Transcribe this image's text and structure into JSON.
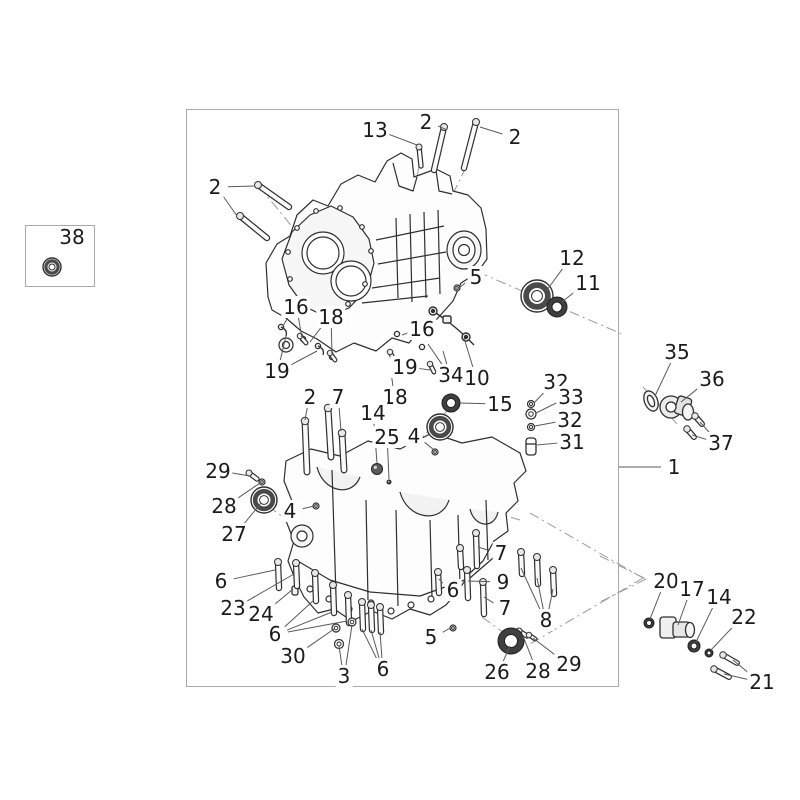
{
  "page": {
    "background": "#ffffff"
  },
  "inset_panel": {
    "part_label": "38",
    "box": [
      25,
      225,
      68,
      60
    ]
  },
  "diagram": {
    "box": [
      186,
      109,
      431,
      576
    ],
    "border_color": "#a9a9a9",
    "art_color": "#2f2f2f",
    "leader_color": "#5a5a5a",
    "phantom_color": "#9b9b9b",
    "drawing_subject": "engine-crankcase-exploded-view",
    "callouts": [
      {
        "text": "13",
        "x": 375,
        "y": 130,
        "targets": [
          [
            417,
            145
          ]
        ]
      },
      {
        "text": "2",
        "x": 426,
        "y": 122,
        "targets": [
          [
            447,
            130
          ]
        ]
      },
      {
        "text": "2",
        "x": 515,
        "y": 137,
        "targets": [
          [
            480,
            127
          ]
        ]
      },
      {
        "text": "2",
        "x": 215,
        "y": 187,
        "targets": [
          [
            254,
            186
          ],
          [
            237,
            216
          ]
        ]
      },
      {
        "text": "12",
        "x": 572,
        "y": 258,
        "targets": [
          [
            547,
            290
          ]
        ]
      },
      {
        "text": "11",
        "x": 588,
        "y": 283,
        "targets": [
          [
            562,
            302
          ]
        ]
      },
      {
        "text": "5",
        "x": 476,
        "y": 277,
        "targets": [
          [
            459,
            288
          ]
        ]
      },
      {
        "text": "16",
        "x": 296,
        "y": 307,
        "targets": [
          [
            283,
            326
          ],
          [
            302,
            338
          ]
        ]
      },
      {
        "text": "18",
        "x": 331,
        "y": 317,
        "targets": [
          [
            310,
            342
          ],
          [
            332,
            355
          ]
        ]
      },
      {
        "text": "19",
        "x": 277,
        "y": 371,
        "targets": [
          [
            286,
            336
          ],
          [
            317,
            351
          ]
        ]
      },
      {
        "text": "16",
        "x": 422,
        "y": 329,
        "targets": [
          [
            402,
            335
          ]
        ]
      },
      {
        "text": "19",
        "x": 405,
        "y": 367,
        "targets": [
          [
            393,
            359
          ],
          [
            430,
            370
          ]
        ]
      },
      {
        "text": "34",
        "x": 451,
        "y": 375,
        "targets": [
          [
            428,
            344
          ],
          [
            443,
            351
          ]
        ]
      },
      {
        "text": "10",
        "x": 477,
        "y": 378,
        "targets": [
          [
            464,
            338
          ]
        ]
      },
      {
        "text": "18",
        "x": 395,
        "y": 397,
        "targets": [
          [
            391,
            372
          ]
        ]
      },
      {
        "text": "15",
        "x": 500,
        "y": 404,
        "targets": [
          [
            460,
            403
          ]
        ]
      },
      {
        "text": "32",
        "x": 556,
        "y": 382,
        "targets": [
          [
            534,
            403
          ]
        ]
      },
      {
        "text": "33",
        "x": 571,
        "y": 397,
        "targets": [
          [
            536,
            413
          ]
        ]
      },
      {
        "text": "32",
        "x": 570,
        "y": 420,
        "targets": [
          [
            535,
            426
          ]
        ]
      },
      {
        "text": "31",
        "x": 572,
        "y": 442,
        "targets": [
          [
            537,
            445
          ]
        ]
      },
      {
        "text": "35",
        "x": 677,
        "y": 352,
        "targets": [
          [
            655,
            396
          ]
        ]
      },
      {
        "text": "36",
        "x": 712,
        "y": 379,
        "targets": [
          [
            681,
            402
          ]
        ]
      },
      {
        "text": "37",
        "x": 721,
        "y": 443,
        "targets": [
          [
            700,
            422
          ],
          [
            692,
            435
          ]
        ]
      },
      {
        "text": "1",
        "x": 674,
        "y": 467,
        "targets": [
          [
            618,
            467
          ]
        ]
      },
      {
        "text": "14",
        "x": 373,
        "y": 413,
        "targets": [
          [
            377,
            463
          ]
        ]
      },
      {
        "text": "25",
        "x": 387,
        "y": 437,
        "targets": [
          [
            389,
            479
          ]
        ]
      },
      {
        "text": "4",
        "x": 414,
        "y": 436,
        "targets": [
          [
            434,
            450
          ]
        ]
      },
      {
        "text": "2",
        "x": 310,
        "y": 397,
        "targets": [
          [
            305,
            420
          ]
        ]
      },
      {
        "text": "7",
        "x": 338,
        "y": 397,
        "targets": [
          [
            341,
            431
          ]
        ]
      },
      {
        "text": "29",
        "x": 218,
        "y": 471,
        "targets": [
          [
            250,
            476
          ]
        ]
      },
      {
        "text": "28",
        "x": 224,
        "y": 506,
        "targets": [
          [
            260,
            483
          ]
        ]
      },
      {
        "text": "27",
        "x": 234,
        "y": 534,
        "targets": [
          [
            261,
            503
          ]
        ]
      },
      {
        "text": "4",
        "x": 290,
        "y": 511,
        "targets": [
          [
            314,
            506
          ]
        ]
      },
      {
        "text": "6",
        "x": 221,
        "y": 581,
        "targets": [
          [
            275,
            570
          ]
        ]
      },
      {
        "text": "23",
        "x": 233,
        "y": 608,
        "targets": [
          [
            294,
            574
          ]
        ]
      },
      {
        "text": "24",
        "x": 261,
        "y": 614,
        "targets": [
          [
            293,
            589
          ]
        ]
      },
      {
        "text": "6",
        "x": 275,
        "y": 634,
        "targets": [
          [
            314,
            600
          ],
          [
            332,
            612
          ],
          [
            347,
            621
          ]
        ]
      },
      {
        "text": "30",
        "x": 293,
        "y": 656,
        "targets": [
          [
            334,
            629
          ]
        ]
      },
      {
        "text": "3",
        "x": 344,
        "y": 676,
        "targets": [
          [
            339,
            646
          ],
          [
            352,
            625
          ]
        ]
      },
      {
        "text": "6",
        "x": 383,
        "y": 669,
        "targets": [
          [
            362,
            629
          ],
          [
            371,
            630
          ],
          [
            380,
            632
          ]
        ]
      },
      {
        "text": "5",
        "x": 431,
        "y": 637,
        "targets": [
          [
            452,
            627
          ]
        ]
      },
      {
        "text": "7",
        "x": 501,
        "y": 553,
        "targets": [
          [
            478,
            547
          ]
        ]
      },
      {
        "text": "9",
        "x": 503,
        "y": 582,
        "targets": [
          [
            468,
            581
          ]
        ]
      },
      {
        "text": "6",
        "x": 453,
        "y": 590,
        "targets": [
          [
            439,
            579
          ]
        ]
      },
      {
        "text": "7",
        "x": 505,
        "y": 608,
        "targets": [
          [
            484,
            597
          ]
        ]
      },
      {
        "text": "8",
        "x": 546,
        "y": 620,
        "targets": [
          [
            521,
            568
          ],
          [
            537,
            578
          ],
          [
            553,
            589
          ]
        ]
      },
      {
        "text": "26",
        "x": 497,
        "y": 672,
        "targets": [
          [
            510,
            646
          ]
        ]
      },
      {
        "text": "28",
        "x": 538,
        "y": 671,
        "targets": [
          [
            523,
            636
          ]
        ]
      },
      {
        "text": "29",
        "x": 569,
        "y": 664,
        "targets": [
          [
            533,
            638
          ]
        ]
      },
      {
        "text": "20",
        "x": 666,
        "y": 581,
        "targets": [
          [
            650,
            619
          ]
        ]
      },
      {
        "text": "17",
        "x": 692,
        "y": 589,
        "targets": [
          [
            678,
            625
          ]
        ]
      },
      {
        "text": "14",
        "x": 719,
        "y": 597,
        "targets": [
          [
            696,
            642
          ]
        ]
      },
      {
        "text": "22",
        "x": 744,
        "y": 617,
        "targets": [
          [
            711,
            650
          ]
        ]
      },
      {
        "text": "21",
        "x": 762,
        "y": 682,
        "targets": [
          [
            733,
            660
          ],
          [
            724,
            674
          ]
        ]
      },
      {
        "text": "38",
        "x": 72,
        "y": 237,
        "targets": []
      }
    ],
    "fasteners": [
      {
        "name": "stud-bolt",
        "x1": 419,
        "y1": 147,
        "x2": 421,
        "y2": 166,
        "w": 3
      },
      {
        "name": "stud-bolt",
        "x1": 444,
        "y1": 127,
        "x2": 434,
        "y2": 170,
        "w": 4
      },
      {
        "name": "stud-bolt",
        "x1": 476,
        "y1": 122,
        "x2": 464,
        "y2": 168,
        "w": 4
      },
      {
        "name": "stud-bolt",
        "x1": 258,
        "y1": 185,
        "x2": 289,
        "y2": 207,
        "w": 4
      },
      {
        "name": "stud-bolt",
        "x1": 240,
        "y1": 216,
        "x2": 267,
        "y2": 238,
        "w": 4
      },
      {
        "name": "stud-bolt",
        "x1": 305,
        "y1": 421,
        "x2": 307,
        "y2": 472,
        "w": 4.5
      },
      {
        "name": "stud-bolt",
        "x1": 328,
        "y1": 408,
        "x2": 331,
        "y2": 457,
        "w": 4.5
      },
      {
        "name": "stud-bolt",
        "x1": 342,
        "y1": 433,
        "x2": 344,
        "y2": 470,
        "w": 4.5
      },
      {
        "name": "hex-bolt",
        "x1": 278,
        "y1": 562,
        "x2": 279,
        "y2": 588,
        "w": 4
      },
      {
        "name": "hex-bolt",
        "x1": 296,
        "y1": 563,
        "x2": 297,
        "y2": 586,
        "w": 4
      },
      {
        "name": "hex-bolt",
        "x1": 315,
        "y1": 573,
        "x2": 316,
        "y2": 601,
        "w": 4
      },
      {
        "name": "hex-bolt",
        "x1": 333,
        "y1": 585,
        "x2": 334,
        "y2": 613,
        "w": 4
      },
      {
        "name": "hex-bolt",
        "x1": 348,
        "y1": 595,
        "x2": 349,
        "y2": 623,
        "w": 4
      },
      {
        "name": "hex-bolt",
        "x1": 362,
        "y1": 602,
        "x2": 363,
        "y2": 629,
        "w": 4
      },
      {
        "name": "hex-bolt",
        "x1": 371,
        "y1": 605,
        "x2": 372,
        "y2": 630,
        "w": 4
      },
      {
        "name": "hex-bolt",
        "x1": 380,
        "y1": 607,
        "x2": 381,
        "y2": 632,
        "w": 4
      },
      {
        "name": "hex-bolt",
        "x1": 438,
        "y1": 572,
        "x2": 439,
        "y2": 593,
        "w": 4
      },
      {
        "name": "hex-bolt",
        "x1": 467,
        "y1": 570,
        "x2": 468,
        "y2": 598,
        "w": 4
      },
      {
        "name": "hex-bolt",
        "x1": 483,
        "y1": 582,
        "x2": 484,
        "y2": 614,
        "w": 4
      },
      {
        "name": "hex-bolt",
        "x1": 476,
        "y1": 533,
        "x2": 477,
        "y2": 566,
        "w": 4
      },
      {
        "name": "hex-bolt",
        "x1": 460,
        "y1": 548,
        "x2": 461,
        "y2": 567,
        "w": 4
      },
      {
        "name": "hex-bolt",
        "x1": 521,
        "y1": 552,
        "x2": 522,
        "y2": 574,
        "w": 4
      },
      {
        "name": "hex-bolt",
        "x1": 537,
        "y1": 557,
        "x2": 538,
        "y2": 584,
        "w": 4
      },
      {
        "name": "hex-bolt",
        "x1": 553,
        "y1": 570,
        "x2": 554,
        "y2": 594,
        "w": 4
      },
      {
        "name": "screw",
        "x1": 695,
        "y1": 416,
        "x2": 702,
        "y2": 424,
        "w": 3.5
      },
      {
        "name": "screw",
        "x1": 687,
        "y1": 429,
        "x2": 694,
        "y2": 437,
        "w": 3.5
      },
      {
        "name": "screw",
        "x1": 723,
        "y1": 655,
        "x2": 737,
        "y2": 663,
        "w": 3.5
      },
      {
        "name": "screw",
        "x1": 714,
        "y1": 669,
        "x2": 729,
        "y2": 677,
        "w": 3.5
      },
      {
        "name": "screw",
        "x1": 249,
        "y1": 473,
        "x2": 257,
        "y2": 479,
        "w": 3
      },
      {
        "name": "screw",
        "x1": 519,
        "y1": 631,
        "x2": 527,
        "y2": 636,
        "w": 3
      },
      {
        "name": "screw",
        "x1": 529,
        "y1": 635,
        "x2": 535,
        "y2": 639,
        "w": 2.5
      },
      {
        "name": "screw",
        "x1": 300,
        "y1": 336,
        "x2": 306,
        "y2": 343,
        "w": 2.5
      },
      {
        "name": "screw",
        "x1": 330,
        "y1": 353,
        "x2": 335,
        "y2": 360,
        "w": 2.5
      },
      {
        "name": "screw",
        "x1": 390,
        "y1": 352,
        "x2": 394,
        "y2": 360,
        "w": 2.5
      },
      {
        "name": "screw",
        "x1": 430,
        "y1": 364,
        "x2": 434,
        "y2": 372,
        "w": 2.5
      }
    ],
    "rings": [
      {
        "name": "ball-bearing",
        "cx": 537,
        "cy": 296,
        "r": 16,
        "style": "bearing"
      },
      {
        "name": "oil-seal",
        "cx": 557,
        "cy": 307,
        "r": 10,
        "style": "seal"
      },
      {
        "name": "roller-bearing",
        "cx": 451,
        "cy": 403,
        "r": 9,
        "style": "seal"
      },
      {
        "name": "ball-bearing",
        "cx": 440,
        "cy": 427,
        "r": 13,
        "style": "bearing"
      },
      {
        "name": "ball-bearing",
        "cx": 264,
        "cy": 500,
        "r": 13,
        "style": "bearing"
      },
      {
        "name": "oil-seal",
        "cx": 511,
        "cy": 641,
        "r": 13,
        "style": "seal"
      },
      {
        "name": "o-ring",
        "cx": 649,
        "cy": 623,
        "r": 5,
        "style": "seal"
      },
      {
        "name": "washer",
        "cx": 694,
        "cy": 646,
        "r": 6,
        "style": "seal"
      },
      {
        "name": "o-ring",
        "cx": 709,
        "cy": 653,
        "r": 4,
        "style": "seal"
      },
      {
        "name": "washer",
        "cx": 531,
        "cy": 404,
        "r": 3.5,
        "style": "washer"
      },
      {
        "name": "nut",
        "cx": 531,
        "cy": 414,
        "r": 5,
        "style": "washer"
      },
      {
        "name": "washer",
        "cx": 531,
        "cy": 427,
        "r": 3.5,
        "style": "washer"
      },
      {
        "name": "ball-plug",
        "cx": 377,
        "cy": 469,
        "r": 5.5,
        "style": "ball"
      },
      {
        "name": "ball-plug",
        "cx": 389,
        "cy": 482,
        "r": 2,
        "style": "ball"
      },
      {
        "name": "dowel",
        "cx": 435,
        "cy": 452,
        "r": 3,
        "style": "washer"
      },
      {
        "name": "dowel",
        "cx": 316,
        "cy": 506,
        "r": 3,
        "style": "washer"
      },
      {
        "name": "dowel",
        "cx": 457,
        "cy": 288,
        "r": 3,
        "style": "washer"
      },
      {
        "name": "dowel",
        "cx": 453,
        "cy": 628,
        "r": 3,
        "style": "washer"
      },
      {
        "name": "washer",
        "cx": 336,
        "cy": 628,
        "r": 4,
        "style": "washer"
      },
      {
        "name": "nut",
        "cx": 339,
        "cy": 644,
        "r": 4.5,
        "style": "washer"
      },
      {
        "name": "nut",
        "cx": 352,
        "cy": 622,
        "r": 4,
        "style": "washer"
      },
      {
        "name": "washer",
        "cx": 262,
        "cy": 482,
        "r": 3,
        "style": "washer"
      },
      {
        "name": "roller-bushing",
        "cx": 52,
        "cy": 267,
        "r": 9,
        "style": "bearing"
      }
    ],
    "phantom_lines": [
      [
        259,
        186,
        349,
        297
      ],
      [
        437,
        169,
        386,
        249
      ],
      [
        466,
        167,
        417,
        268
      ],
      [
        419,
        166,
        408,
        228
      ],
      [
        478,
        272,
        622,
        334
      ],
      [
        643,
        387,
        678,
        425
      ],
      [
        268,
        506,
        318,
        543
      ],
      [
        447,
        411,
        398,
        463
      ],
      [
        482,
        617,
        514,
        640
      ],
      [
        300,
        455,
        520,
        520
      ],
      [
        530,
        513,
        643,
        578
      ],
      [
        643,
        578,
        530,
        644
      ],
      [
        600,
        556,
        646,
        579
      ],
      [
        646,
        579,
        600,
        602
      ]
    ]
  }
}
